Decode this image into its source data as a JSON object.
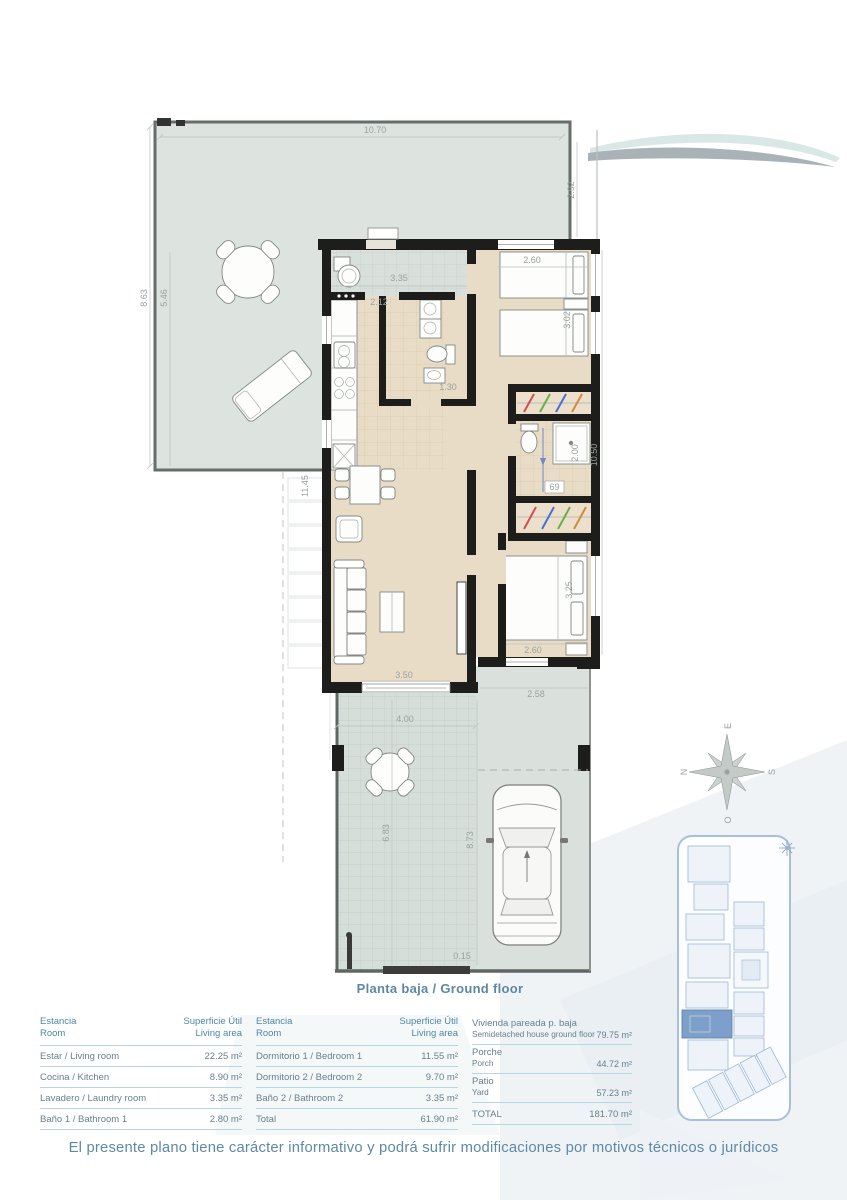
{
  "page": {
    "caption": "Planta baja / Ground floor",
    "disclaimer": "El presente plano tiene carácter informativo y podrá sufrir modificaciones por motivos técnicos o jurídicos"
  },
  "colors": {
    "wall": "#1d1d1b",
    "floor": "#e9dcc6",
    "patio": "#dde3df",
    "porch": "#d5ded8",
    "accent_text": "#5d87a3",
    "table_line": "#b7d6e0",
    "highlight_unit": "#7d9fc9"
  },
  "compass": {
    "north": "N",
    "south": "S",
    "east": "E",
    "west": "O"
  },
  "dims": {
    "patio_width": "10.70",
    "patio_side": "2.92",
    "patio_height_outer": "8.63",
    "patio_height_inner": "5.46",
    "west_length": "11.45",
    "entry_width": "3.35",
    "kitchen_width": "2.12",
    "bed1_width": "2.60",
    "bed1_depth": "3.02",
    "bath1_width": "1.30",
    "east_length": "10.50",
    "bath2_depth": "2.00",
    "basin": "69",
    "bed2_depth": "3.25",
    "bed2_width": "2.60",
    "living_width": "3.50",
    "terrace_width": "2.58",
    "porch_width": "4.00",
    "porch_depth": "6.83",
    "parking_depth": "8.73",
    "step": "0.15"
  },
  "tables": {
    "header": {
      "estancia": "Estancia",
      "room": "Room",
      "superficie": "Superficie Útil",
      "living_area": "Living area"
    },
    "left_rows": [
      {
        "name": "Estar / Living room",
        "area": "22.25 m²"
      },
      {
        "name": "Cocina / Kitchen",
        "area": "8.90 m²"
      },
      {
        "name": "Lavadero / Laundry room",
        "area": "3.35 m²"
      },
      {
        "name": "Baño 1 / Bathroom 1",
        "area": "2.80 m²"
      }
    ],
    "middle_rows": [
      {
        "name": "Dormitorio 1 / Bedroom 1",
        "area": "11.55 m²"
      },
      {
        "name": "Dormitorio 2 / Bedroom 2",
        "area": "9.70 m²"
      },
      {
        "name": "Baño 2 / Bathroom 2",
        "area": "3.35 m²"
      },
      {
        "name": "Total",
        "area": "61.90 m²"
      }
    ],
    "right_rows": [
      {
        "line1": "Vivienda pareada p. baja",
        "line2": "Semidetached house ground floor",
        "area": "79.75 m²"
      },
      {
        "line1": "Porche",
        "line2": "Porch",
        "area": "44.72 m²"
      },
      {
        "line1": "Patio",
        "line2": "Yard",
        "area": "57.23 m²"
      },
      {
        "line1": "TOTAL",
        "line2": "",
        "area": "181.70 m²"
      }
    ]
  }
}
